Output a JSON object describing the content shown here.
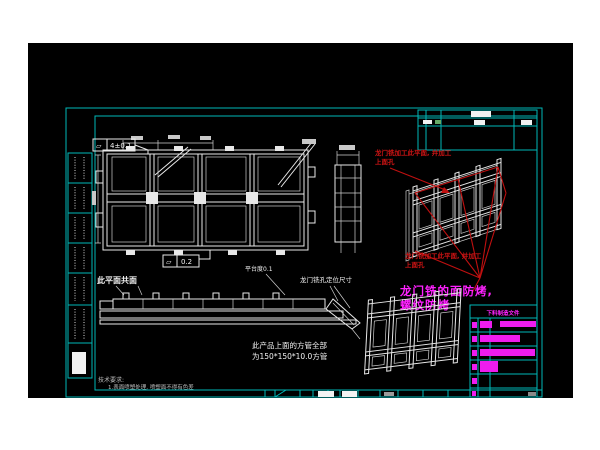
{
  "window": {
    "background": "#ffffff",
    "canvas_background": "#000000"
  },
  "colors": {
    "frame_cyan": "#00b8b8",
    "drawing_white": "#e8e8e8",
    "annotation_red": "#c01010",
    "highlight_magenta": "#ff00ff"
  },
  "callouts": {
    "flatness_top": {
      "symbol": "▱",
      "value": "4±0.1"
    },
    "flatness_mid": {
      "symbol": "▱",
      "value": "0.2"
    },
    "coplanar": "此平面共面",
    "platform_flatness": "平台度0.1",
    "gantry_hole_dims": "龙门铣孔定位尺寸"
  },
  "red_notes": {
    "top": {
      "line1": "龙门铣加工此平面, 并加工",
      "line2": "上面孔"
    },
    "mid": {
      "line1": "龙门铣加工此平面, 并加工",
      "line2": "上面孔"
    }
  },
  "magenta_note": {
    "line1": "龙门铣的面防烤,",
    "line2": "螺纹防烤"
  },
  "product_note": {
    "line1": "此产品上面的方管全部",
    "line2": "为150*150*10.0方管"
  },
  "tech_requirements": {
    "title": "技术要求:",
    "item1": "1.表面喷塑处理, 喷塑面不得有色差"
  },
  "revision_table": {
    "header": "下料制造文件"
  }
}
